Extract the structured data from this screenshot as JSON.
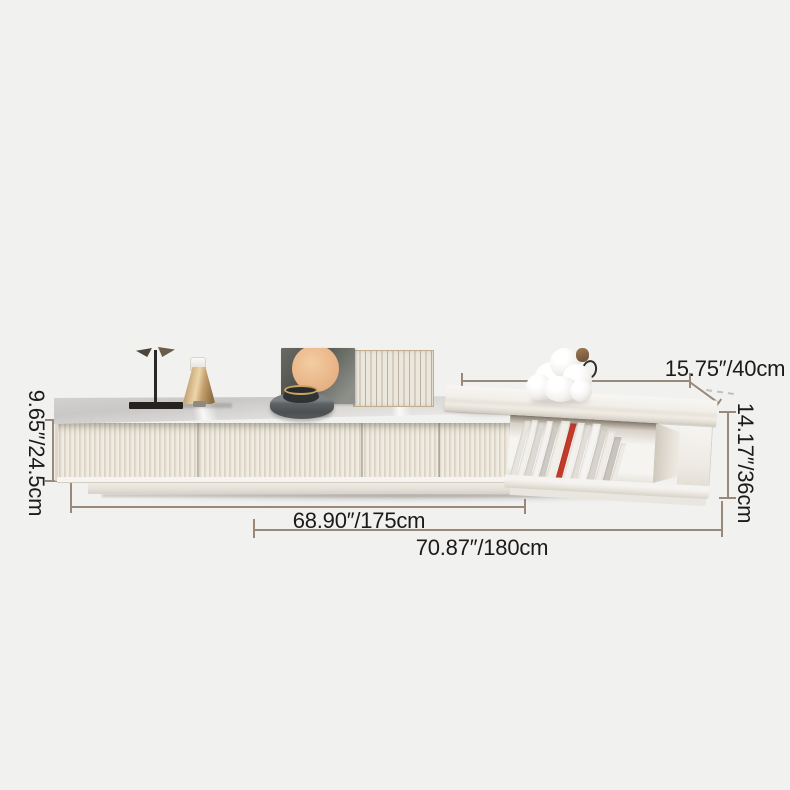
{
  "scene": {
    "description": "Product dimension diagram of a white fluted TV stand with stone top and an extendable raised end table holding magazines",
    "background_color": "#f1f1f0"
  },
  "dimensions": {
    "line_color": "#9a8979",
    "text_color": "#1d1b18",
    "labels": {
      "cabinet_height": "9.65″/24.5cm",
      "cabinet_length": "68.90″/175cm",
      "total_length": "70.87″/180cm",
      "table_depth": "15.75″/40cm",
      "table_height": "14.17″/36cm"
    }
  },
  "decor": {
    "items": [
      "bird-sculpture",
      "gold-cone-vase",
      "stone-art-panel",
      "slatted-art-panel",
      "round-tray-with-brass-bowl",
      "white-knot-sculpture",
      "magazines"
    ]
  },
  "shelf": {
    "books": [
      {
        "w": 6,
        "h": 55,
        "c": "#e8e5e0"
      },
      {
        "w": 5,
        "h": 56,
        "c": "#f3f1ed"
      },
      {
        "w": 7,
        "h": 54,
        "c": "#dedad3"
      },
      {
        "w": 5,
        "h": 56,
        "c": "#f5f3ef"
      },
      {
        "w": 6,
        "h": 53,
        "c": "#cfcbc4"
      },
      {
        "w": 8,
        "h": 57,
        "c": "#f2efe9"
      },
      {
        "w": 6,
        "h": 55,
        "c": "#c23b2b"
      },
      {
        "w": 7,
        "h": 56,
        "c": "#f4f2ee"
      },
      {
        "w": 5,
        "h": 54,
        "c": "#e3dfd8"
      },
      {
        "w": 8,
        "h": 56,
        "c": "#f6f4f0"
      },
      {
        "w": 6,
        "h": 52,
        "c": "#d8d4cd"
      },
      {
        "w": 7,
        "h": 50,
        "c": "#f0ede8"
      },
      {
        "w": 6,
        "h": 44,
        "c": "#c9c5be"
      },
      {
        "w": 5,
        "h": 38,
        "c": "#efece7"
      }
    ]
  }
}
